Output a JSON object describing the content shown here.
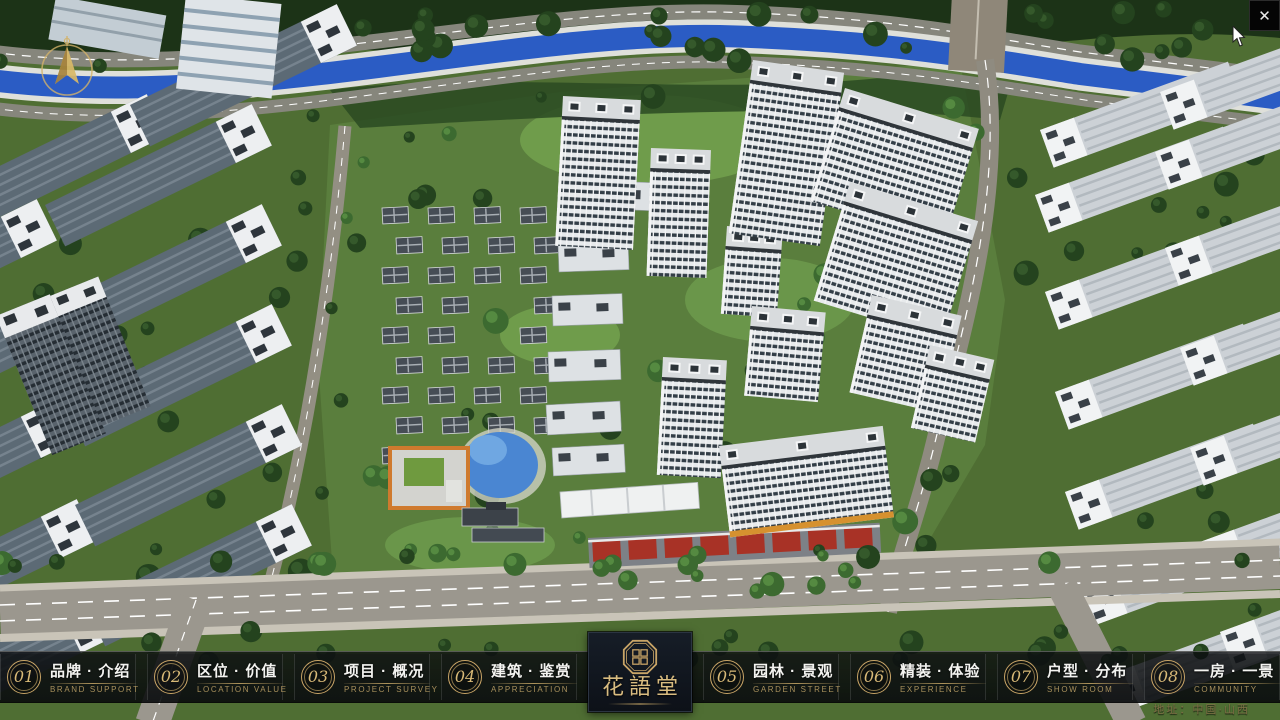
{
  "window": {
    "close_glyph": "✕"
  },
  "nav": {
    "items": [
      {
        "num": "01",
        "label_zh": "品牌 · 介绍",
        "label_en": "BRAND SUPPORT"
      },
      {
        "num": "02",
        "label_zh": "区位 · 价值",
        "label_en": "LOCATION VALUE"
      },
      {
        "num": "03",
        "label_zh": "项目 · 概况",
        "label_en": "PROJECT SURVEY"
      },
      {
        "num": "04",
        "label_zh": "建筑 · 鉴赏",
        "label_en": "APPRECIATION"
      },
      {
        "num": "05",
        "label_zh": "园林 · 景观",
        "label_en": "GARDEN STREET"
      },
      {
        "num": "06",
        "label_zh": "精装 · 体验",
        "label_en": "EXPERIENCE"
      },
      {
        "num": "07",
        "label_zh": "户型 · 分布",
        "label_en": "SHOW ROOM"
      },
      {
        "num": "08",
        "label_zh": "一房 · 一景",
        "label_en": "COMMUNITY"
      }
    ]
  },
  "logo": {
    "title": "花語堂"
  },
  "footer": {
    "address": "地址：中国·山西"
  },
  "colors": {
    "accent_gold": "#c9a567",
    "nav_text": "#f3f3f0",
    "nav_sub_text": "#a8905c",
    "canal_blue": "#2b5cc4",
    "logo_panel_bg": "#0d1118"
  }
}
